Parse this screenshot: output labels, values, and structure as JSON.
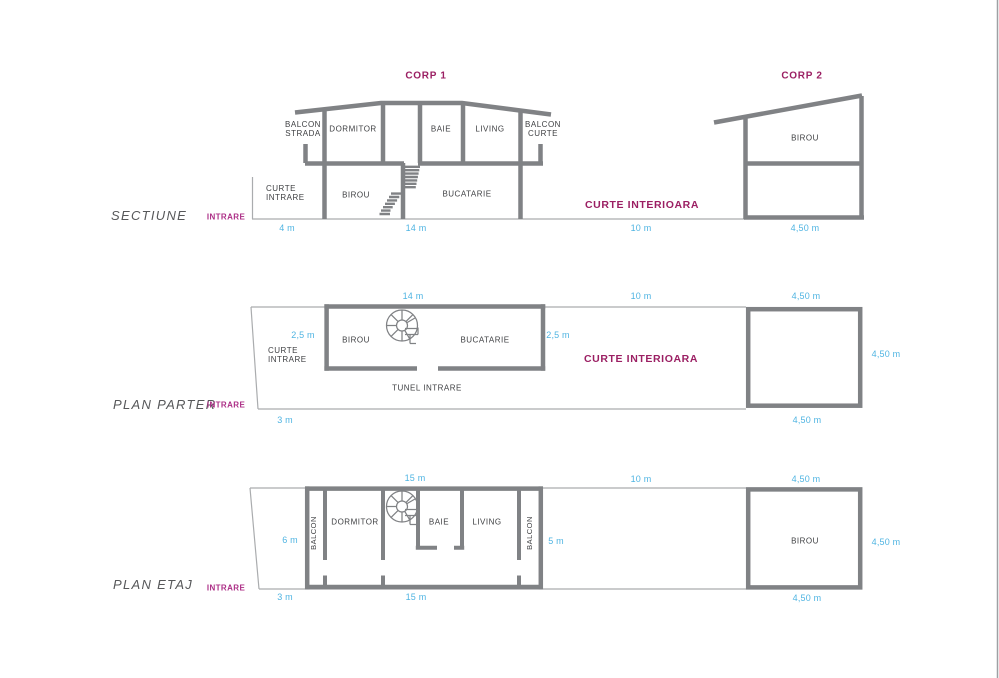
{
  "colors": {
    "wall": "#808285",
    "thin_line": "#aaacae",
    "page_border": "#9ea0a3",
    "room_text": "#3f4043",
    "dimension_text": "#4fb4e2",
    "magenta": "#9b1f63",
    "magenta_entrance": "#ac2e86",
    "view_title_text": "#57585a"
  },
  "sectiune": {
    "title": "SECTIUNE",
    "entrance": "INTRARE",
    "corp1_title": "CORP 1",
    "corp2_title": "CORP 2",
    "rooms": {
      "balcon_strada": "BALCON STRADA",
      "dormitor": "DORMITOR",
      "baie": "BAIE",
      "living": "LIVING",
      "balcon_curte": "BALCON CURTE",
      "curte_intrare": "CURTE INTRARE",
      "birou": "BIROU",
      "bucatarie": "BUCATARIE",
      "curte_interioara": "CURTE INTERIOARA",
      "corp2_birou": "BIROU"
    },
    "dims": {
      "curte_intrare": "4 m",
      "corp1": "14 m",
      "curte_interioara": "10 m",
      "corp2": "4,50 m"
    }
  },
  "plan_parter": {
    "title": "PLAN PARTER",
    "entrance": "INTRARE",
    "rooms": {
      "birou": "BIROU",
      "bucatarie": "BUCATARIE",
      "curte_intrare": "CURTE INTRARE",
      "tunel_intrare": "TUNEL INTRARE",
      "curte_interioara": "CURTE INTERIOARA"
    },
    "dims": {
      "top_corp1": "14 m",
      "top_curte": "10 m",
      "top_corp2": "4,50 m",
      "left_depth": "2,5 m",
      "right_depth": "2,5 m",
      "corp2_side": "4,50 m",
      "bottom_left": "3 m",
      "bottom_corp2": "4,50 m"
    }
  },
  "plan_etaj": {
    "title": "PLAN ETAJ",
    "entrance": "INTRARE",
    "rooms": {
      "balcon_strada": "BALCON",
      "dormitor": "DORMITOR",
      "baie": "BAIE",
      "living": "LIVING",
      "balcon_curte": "BALCON",
      "corp2_birou": "BIROU"
    },
    "dims": {
      "top_corp1": "15 m",
      "top_curte": "10 m",
      "top_corp2": "4,50 m",
      "left_height": "6 m",
      "right_height": "5 m",
      "corp2_side": "4,50 m",
      "bottom_left": "3 m",
      "bottom_corp1": "15 m",
      "bottom_corp2": "4,50 m"
    }
  }
}
